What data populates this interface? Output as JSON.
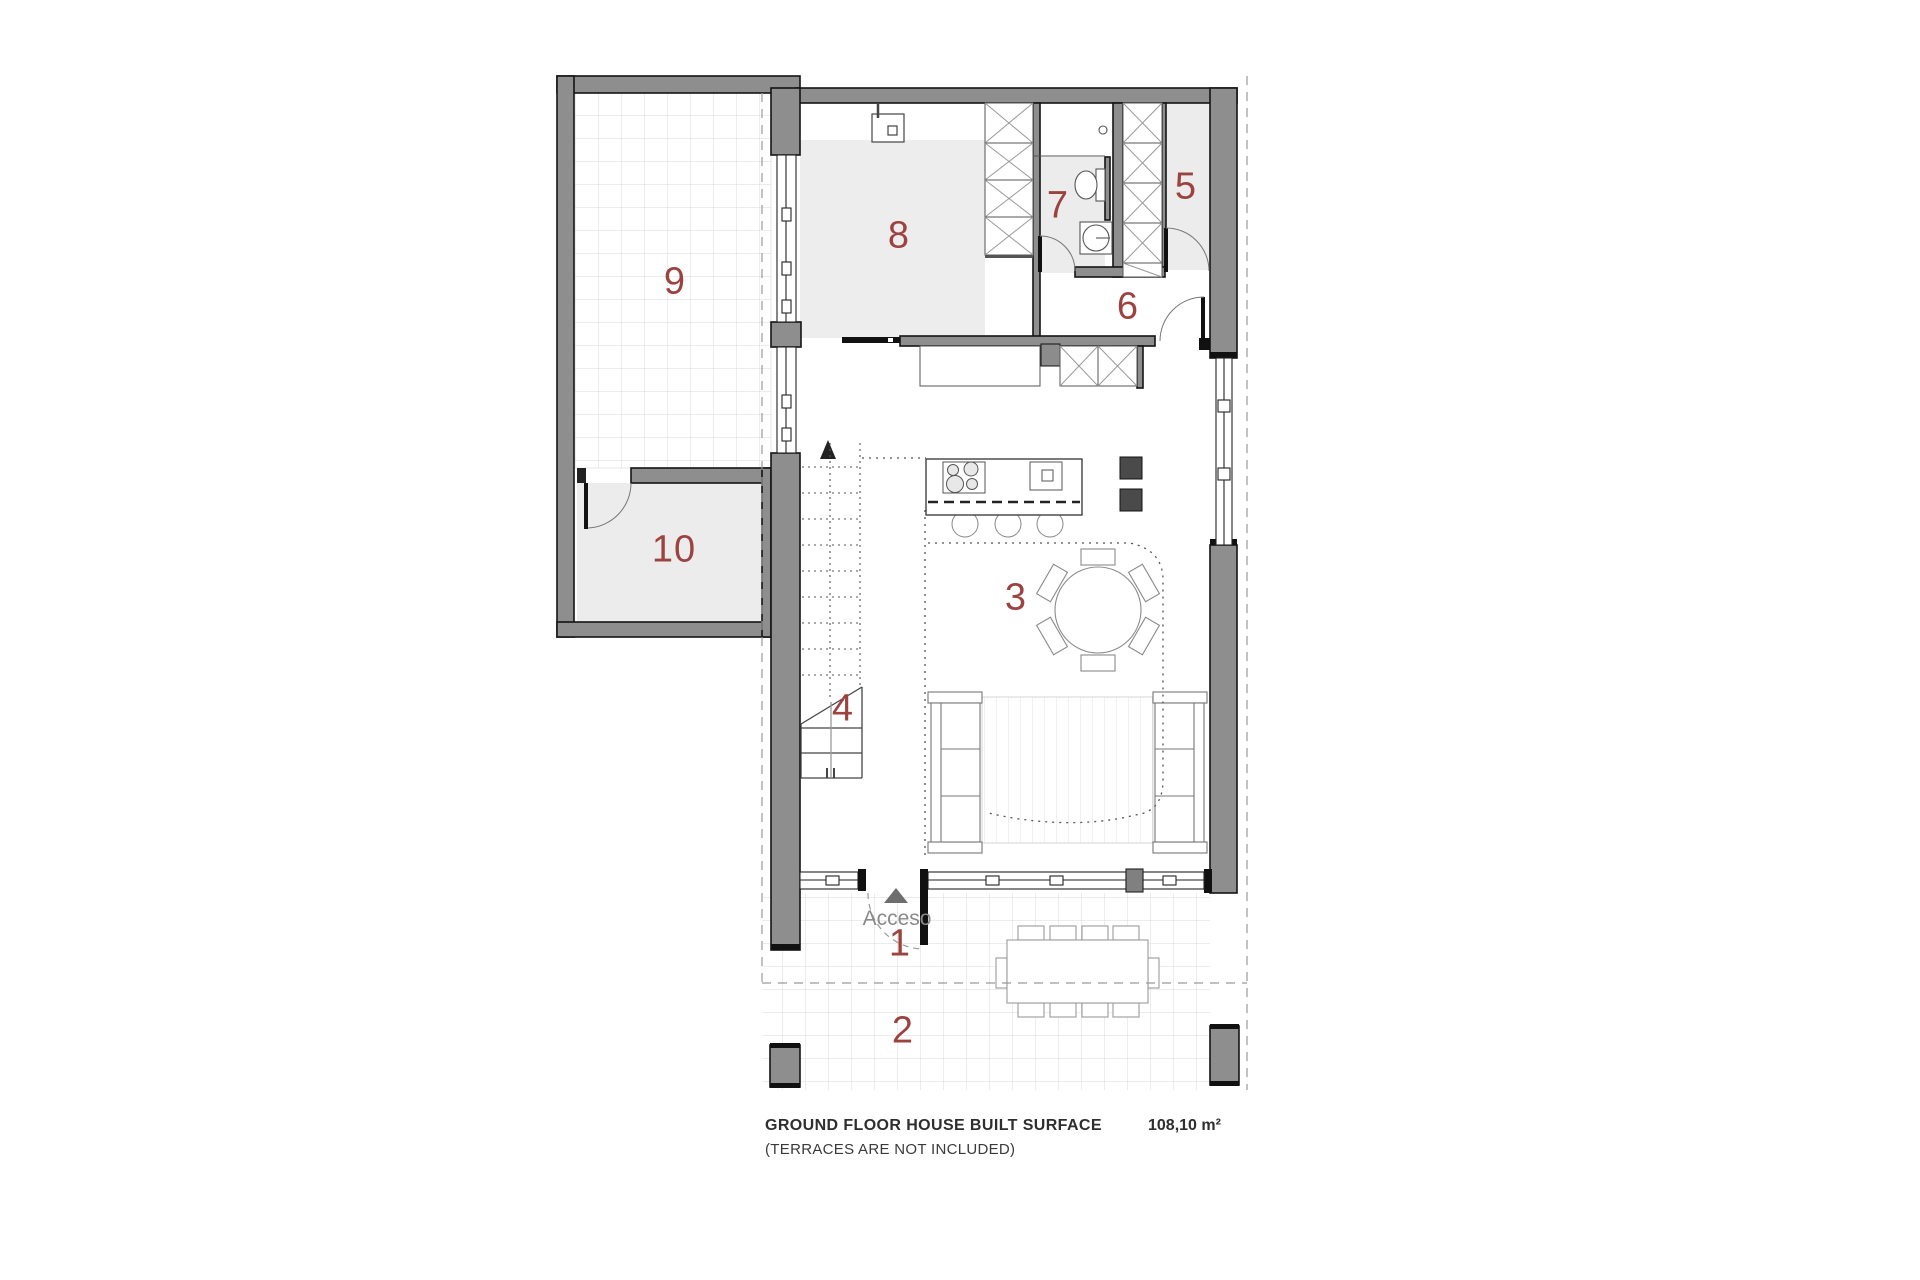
{
  "plan": {
    "room_numbers": [
      "1",
      "2",
      "3",
      "4",
      "5",
      "6",
      "7",
      "8",
      "9",
      "10"
    ],
    "access_label": "Acceso"
  },
  "footer": {
    "title": "GROUND FLOOR HOUSE BUILT SURFACE",
    "note": "(TERRACES ARE NOT INCLUDED)",
    "area": "108,10 m²"
  },
  "colors": {
    "wall_fill": "#8e8e8e",
    "wall_outline": "#141414",
    "room_number": "#9c4340",
    "floor_fill": "#ededed",
    "grid_line": "#d9d9d9",
    "access_text": "#8a8a8a",
    "caption_text": "#2e2e2e"
  }
}
